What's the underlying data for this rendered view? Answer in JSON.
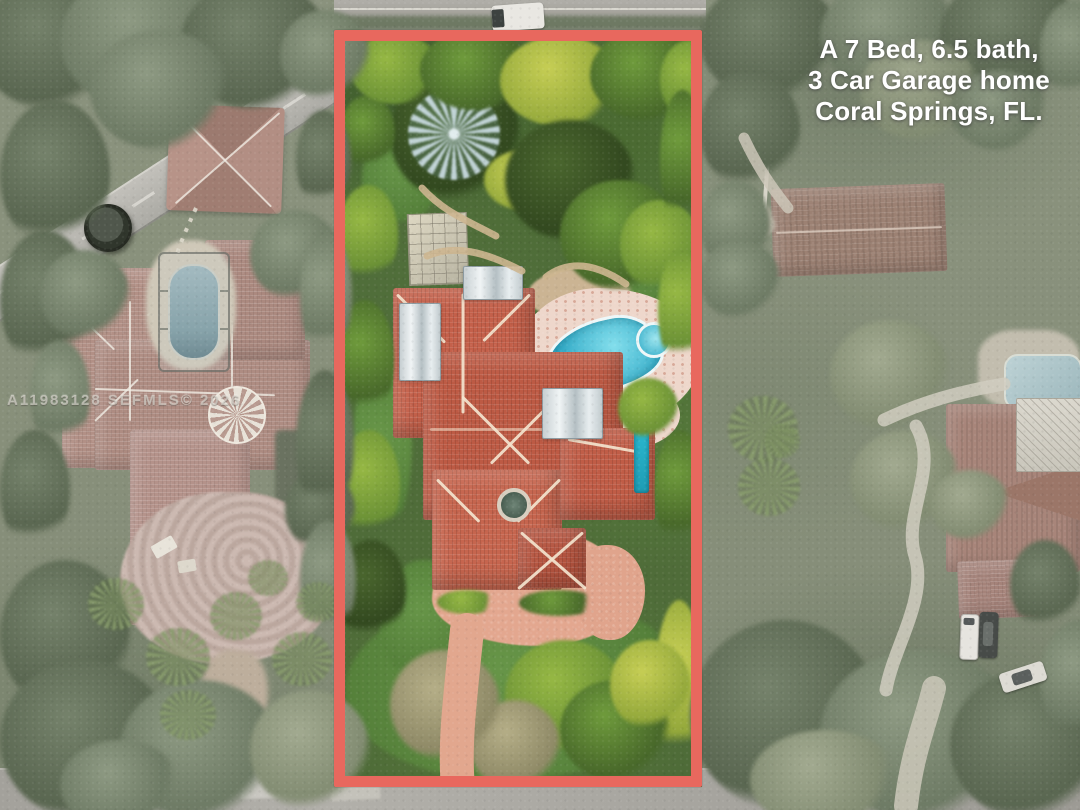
{
  "caption": {
    "line1": "A 7 Bed, 6.5 bath,",
    "line2": "3 Car Garage home",
    "line3": "Coral Springs, FL."
  },
  "watermark": {
    "text": "A11983128 SEFMLS© 2026"
  },
  "boundary": {
    "label": "highlighted property lot",
    "color": "#e8685e"
  },
  "scene": {
    "type": "aerial-photo",
    "description": "drone view of a 7-bed estate with tile roof, pool and circular driveway",
    "colors": {
      "pool_water": "#2fa9c6",
      "roof_tile": "#c4604a",
      "driveway_pavers": "#e2a48c",
      "lawn_vivid": "#5e8c44",
      "surroundings_muted": "#8a927f",
      "road": "#a6a49e"
    }
  }
}
